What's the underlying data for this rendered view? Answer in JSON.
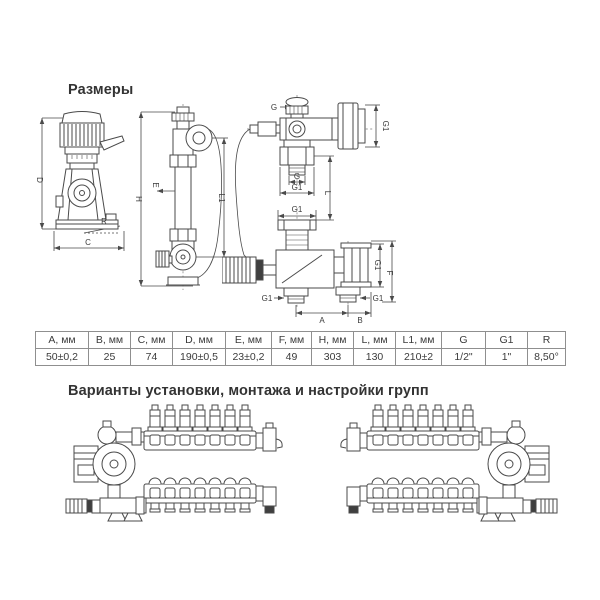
{
  "page": {
    "background": "#ffffff",
    "line_color": "#4a4a4a",
    "text_color": "#333333"
  },
  "sections": {
    "dimensions_title": "Размеры",
    "variants_title": "Варианты установки, монтажа и настройки групп"
  },
  "drawings": {
    "side_view": {
      "labels": {
        "D": "D",
        "R": "R",
        "C": "C"
      }
    },
    "front_view": {
      "labels": {
        "H": "H",
        "E": "E",
        "L1": "L1"
      }
    },
    "port_view": {
      "labels": {
        "G_top": "G",
        "G1_flange": "G1",
        "G_thread": "G",
        "G1_union": "G1",
        "L": "L"
      }
    },
    "valve_view": {
      "labels": {
        "G1_top": "G1",
        "G1_side": "G1",
        "F": "F",
        "G1_left": "G1",
        "G1_right": "G1",
        "A": "A",
        "B": "B"
      }
    }
  },
  "table": {
    "headers": [
      "A, мм",
      "B, мм",
      "C, мм",
      "D, мм",
      "E, мм",
      "F, мм",
      "H, мм",
      "L, мм",
      "L1, мм",
      "G",
      "G1",
      "R"
    ],
    "values": [
      "50±0,2",
      "25",
      "74",
      "190±0,5",
      "23±0,2",
      "49",
      "303",
      "130",
      "210±2",
      "1/2\"",
      "1\"",
      "8,50°"
    ]
  }
}
